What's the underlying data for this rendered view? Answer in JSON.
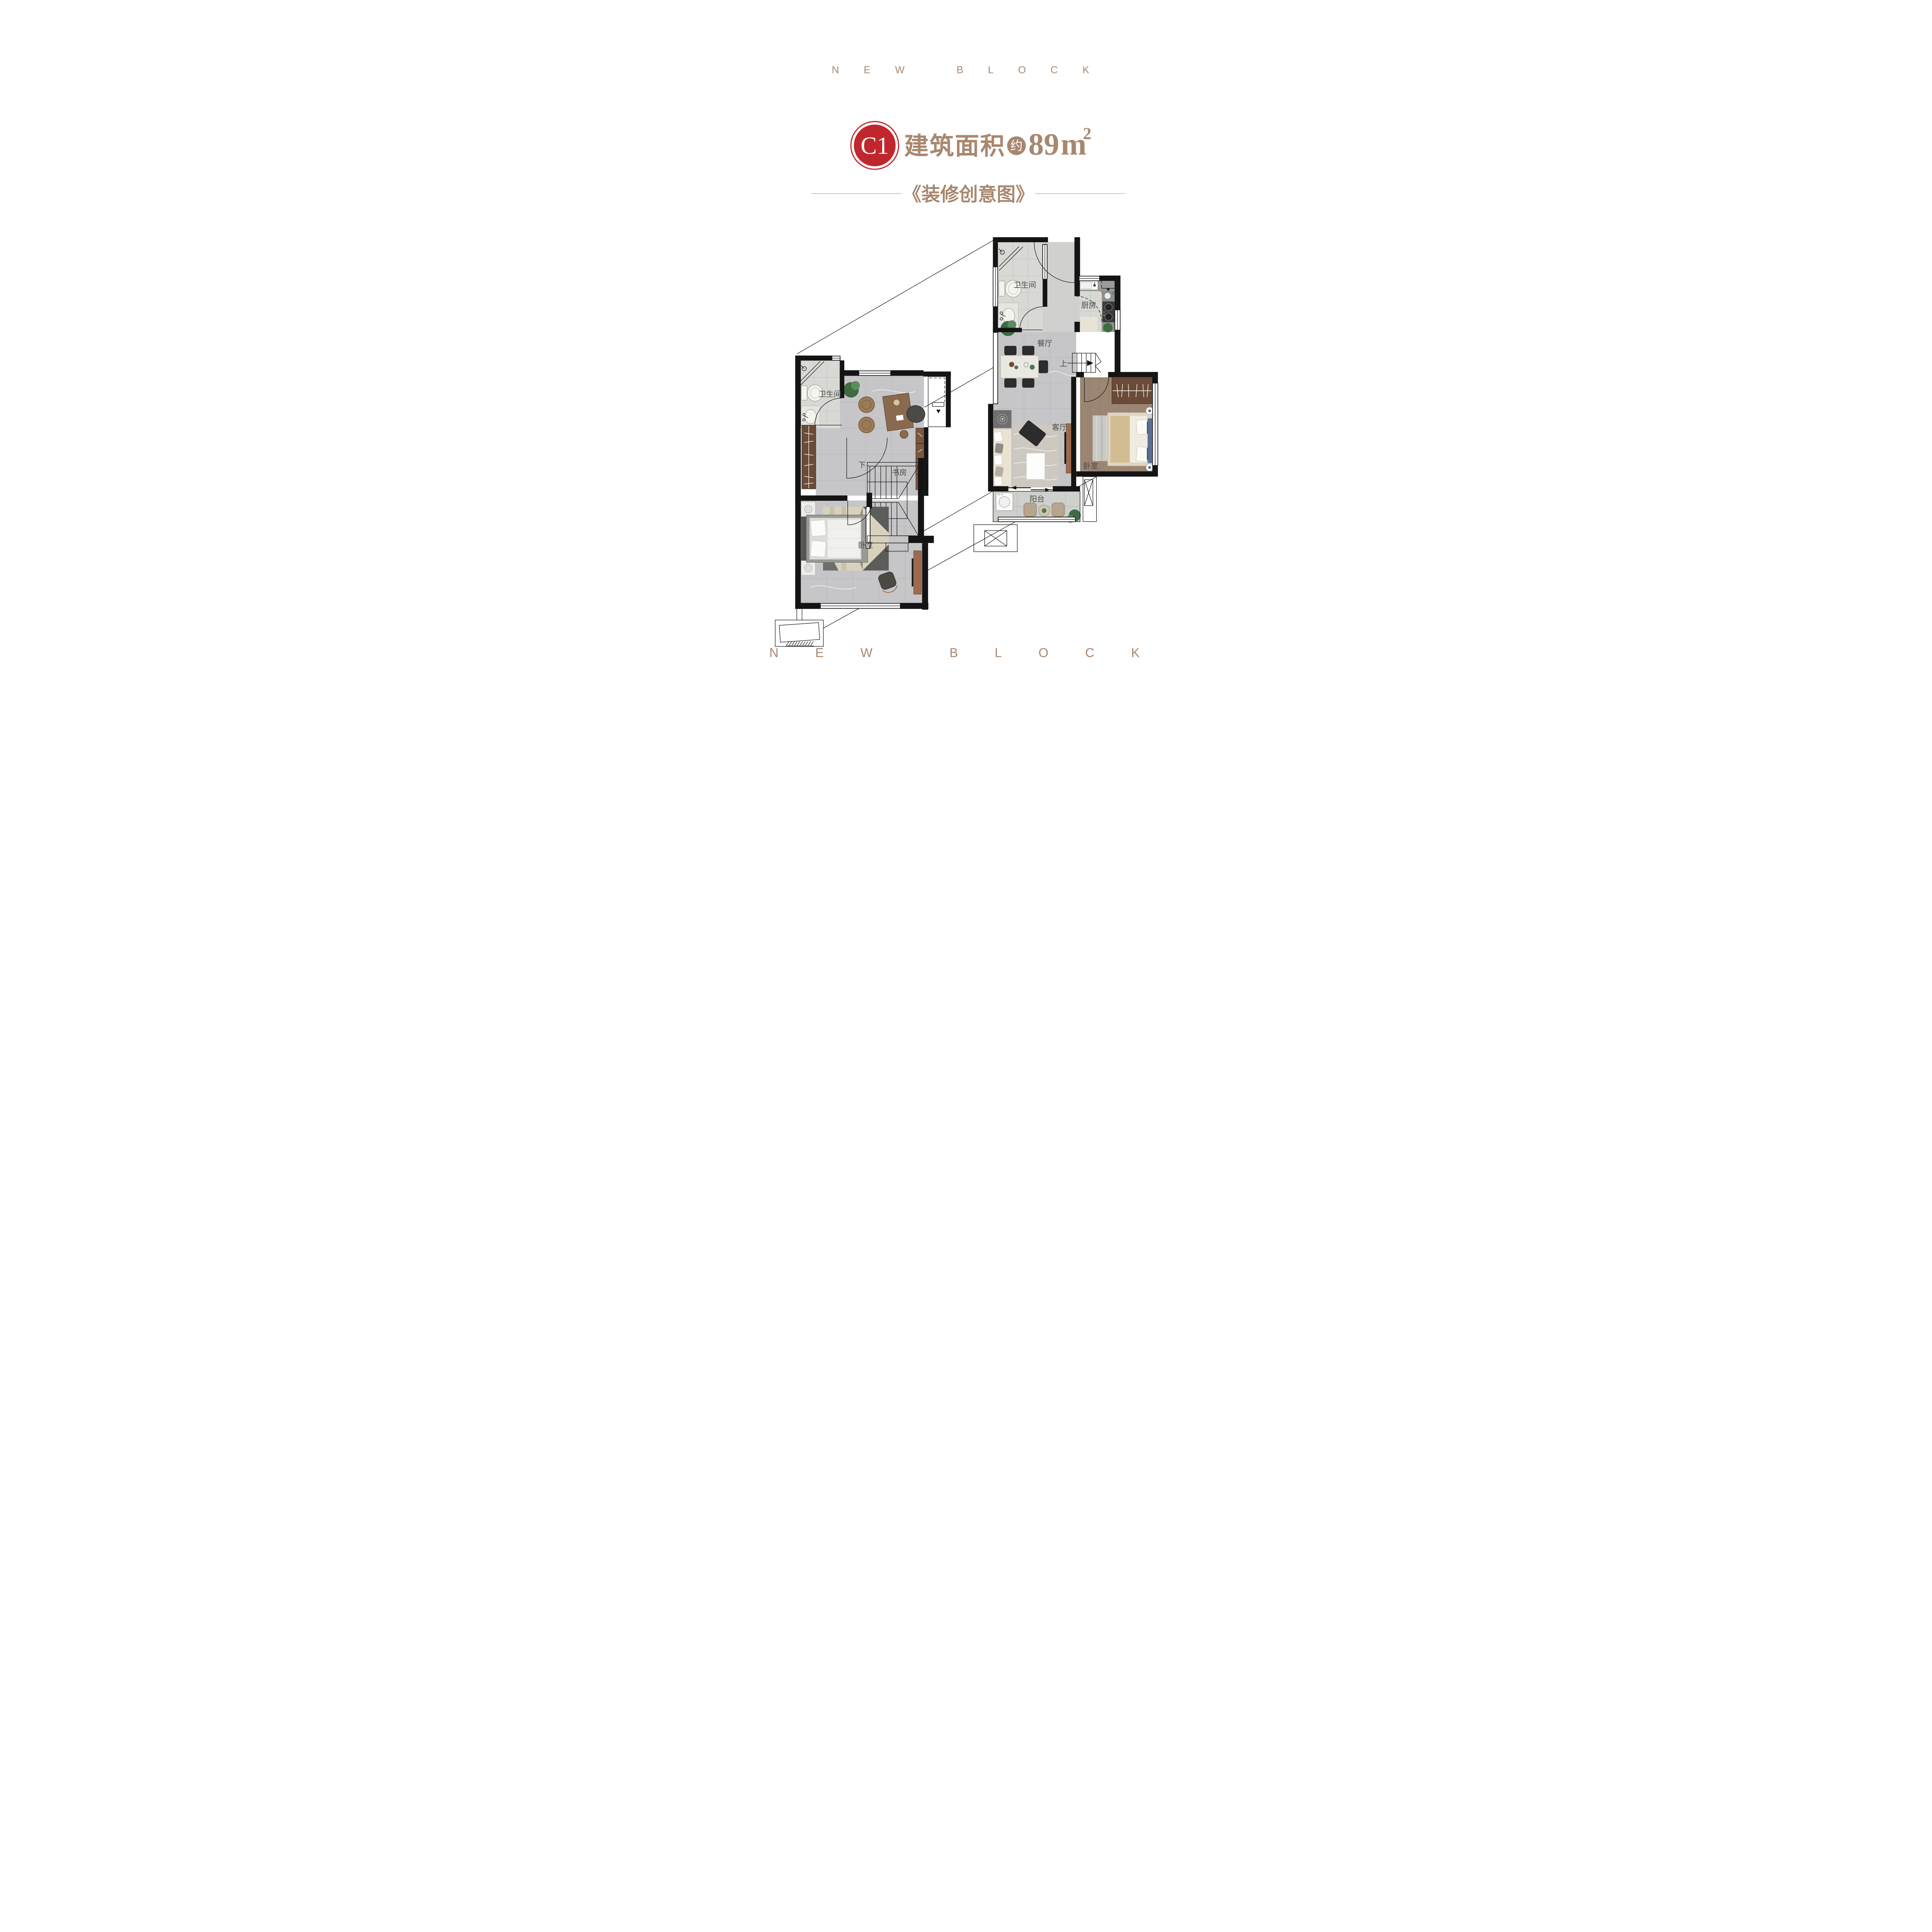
{
  "brand": {
    "top": "NEW BLOCK",
    "bottom": "NEW BLOCK"
  },
  "title": {
    "unit_code": "C1",
    "area_label": "建筑面积",
    "approx_label": "约",
    "area_value": "89",
    "area_unit_letter": "m",
    "area_unit_sup": "2"
  },
  "subtitle": {
    "text": "《装修创意图》"
  },
  "colors": {
    "accent_brown": "#a8876f",
    "badge_red": "#c0272d",
    "wall_black": "#141414",
    "marble_gray": "#c6c6c8",
    "tile_gray": "#d8d8d5",
    "wood_brown": "#9b8673",
    "copper_brown": "#9c6b4e"
  },
  "floor1": {
    "label_bathroom": "卫生间",
    "label_kitchen": "厨房",
    "label_dining": "餐厅",
    "label_living": "客厅",
    "label_bedroom": "卧室",
    "label_balcony": "阳台",
    "stair_direction": "上"
  },
  "floor2": {
    "label_bathroom": "卫生间",
    "label_study": "书房",
    "label_bedroom": "卧室",
    "stair_direction": "下"
  }
}
